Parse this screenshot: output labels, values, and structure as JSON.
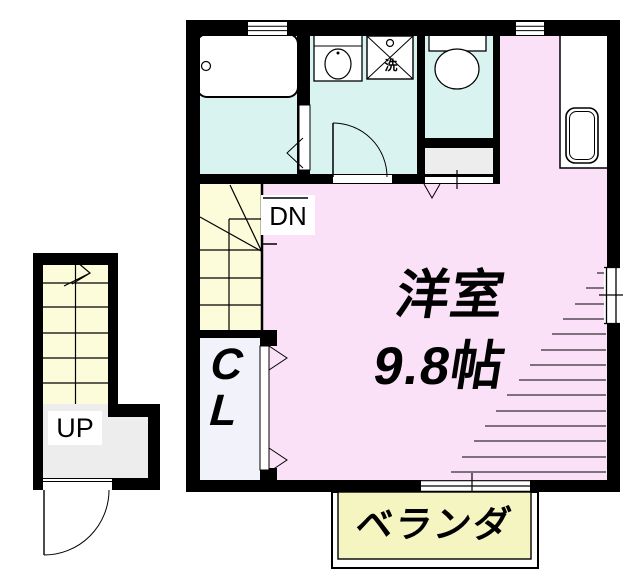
{
  "floorplan": {
    "rooms": {
      "western_room": {
        "name_line": "洋室",
        "size_line": "9.8帖"
      },
      "closet": {
        "letter1": "C",
        "letter2": "L"
      },
      "balcony": {
        "label": "ベランダ"
      },
      "stairs": {
        "down": "DN",
        "up": "UP"
      },
      "laundry": {
        "label": "洗"
      }
    },
    "colors": {
      "wall": "#000000",
      "room_pink": "#fbe1f7",
      "wet_area_cyan": "#d9f4f0",
      "stairs_yellow": "#fcfcdb",
      "balcony_yellow": "#f5f5c2",
      "closet_white": "#f2f2fa",
      "hall_gray": "#ededed",
      "background": "#ffffff"
    }
  }
}
